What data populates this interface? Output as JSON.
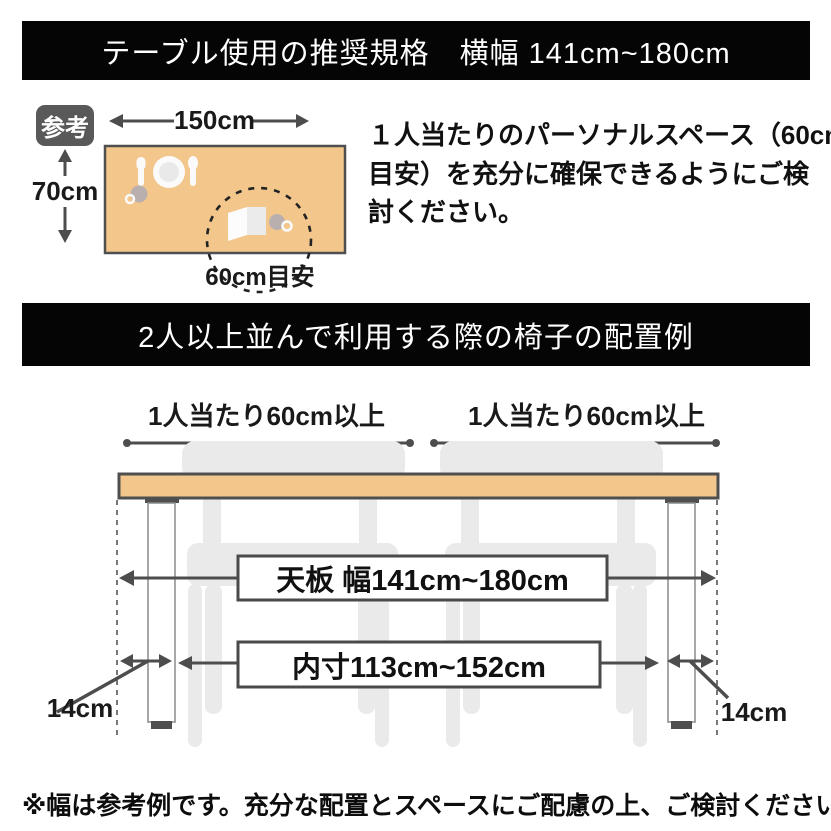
{
  "banners": {
    "top": "テーブル使用の推奨規格　横幅 141cm~180cm",
    "arrangement": "2人以上並んで利用する際の椅子の配置例"
  },
  "reference": {
    "badge": "参考",
    "width_label": "150cm",
    "depth_label": "70cm",
    "space_label": "60cm目安",
    "note_lines": [
      "１人当たりのパーソナルスペース（60cm",
      "目安）を充分に確保できるようにご検",
      "討ください。"
    ]
  },
  "arrangement": {
    "left_seat_label": "1人当たり60cm以上",
    "right_seat_label": "1人当たり60cm以上",
    "tabletop_label": "天板 幅141cm~180cm",
    "inner_label": "内寸113cm~152cm",
    "left_leg_label": "14cm",
    "right_leg_label": "14cm"
  },
  "footnote": "※幅は参考例です。充分な配置とスペースにご配慮の上、ご検討ください。",
  "colors": {
    "table": "#F3C78C",
    "line": "#4D4D4D",
    "edge": "#4F4F4F",
    "chair": "#EAEAEA",
    "banner_bg": "#050505",
    "badge_bg": "#595959"
  }
}
